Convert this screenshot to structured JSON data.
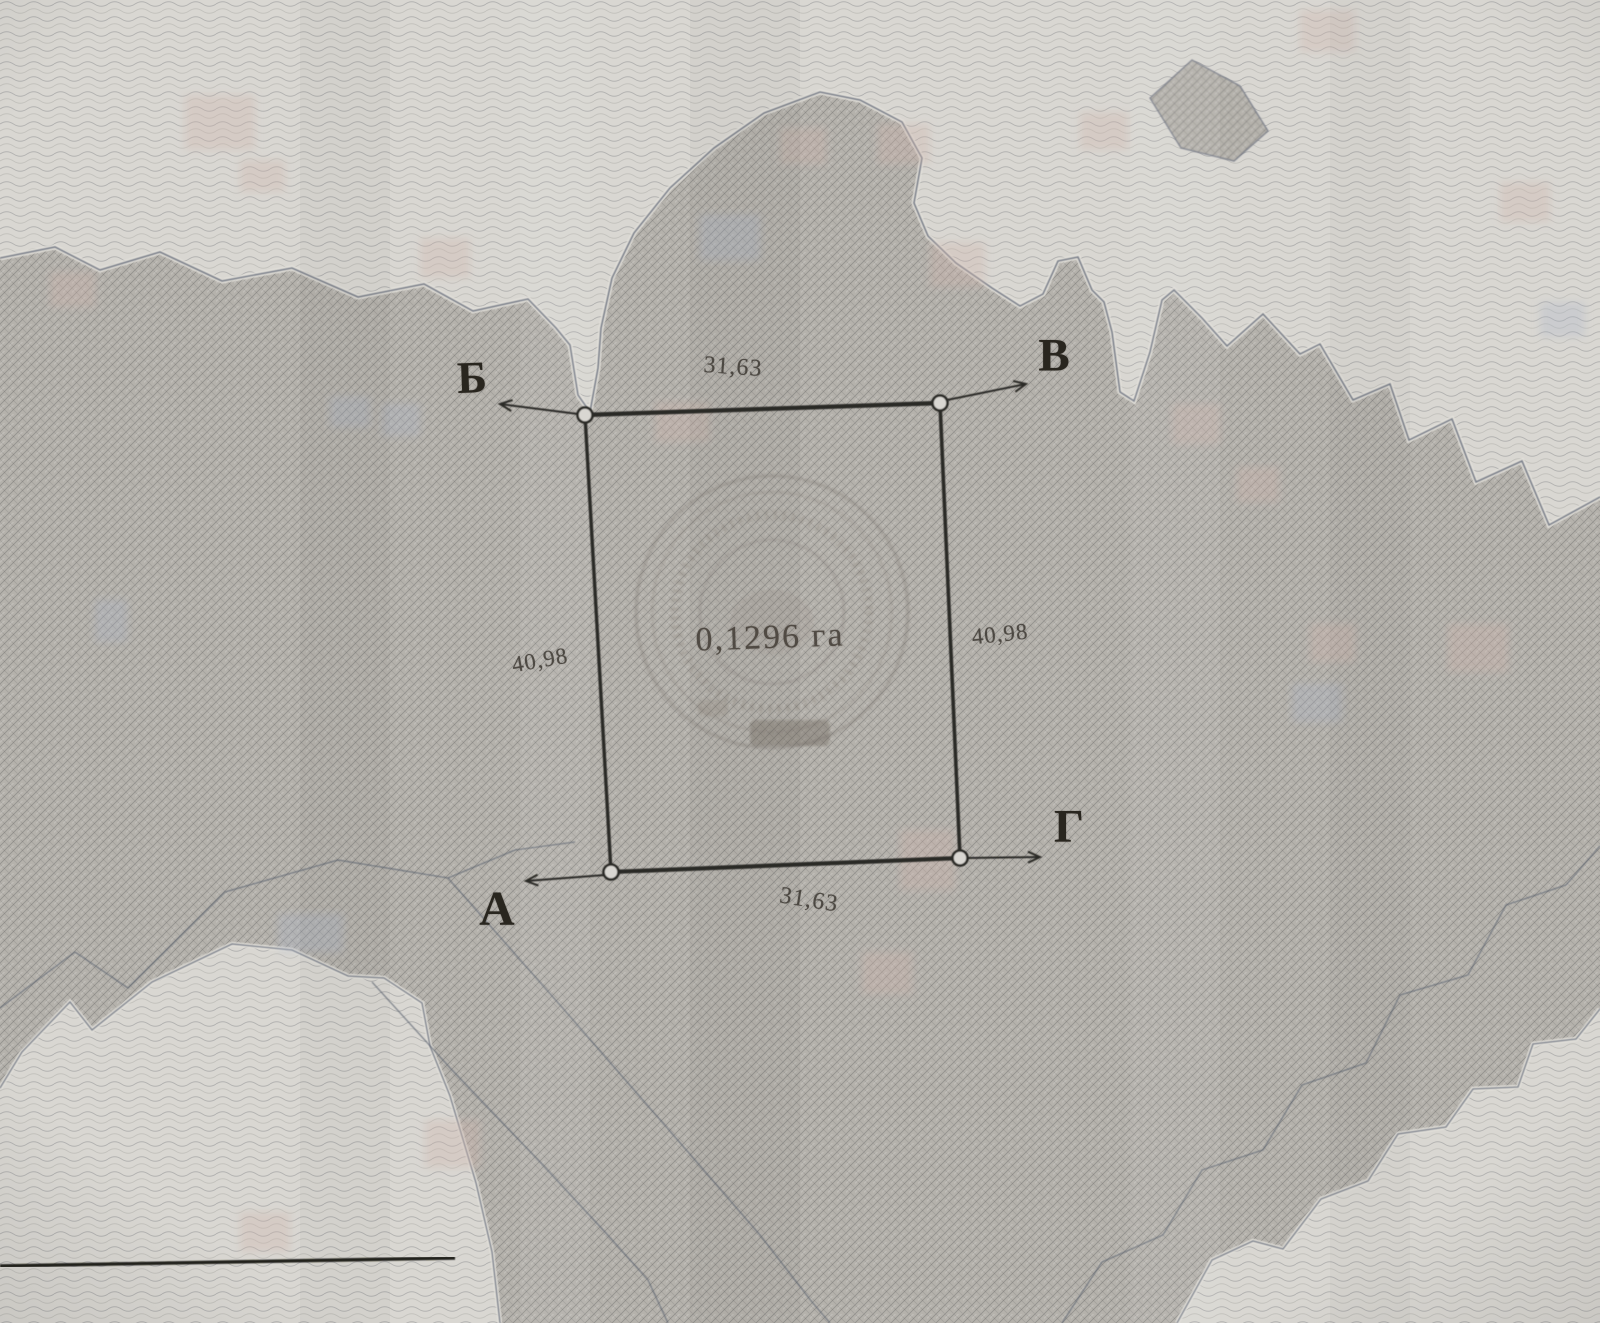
{
  "plot": {
    "corner_labels": {
      "top_left": "Б",
      "top_right": "В",
      "bottom_left": "А",
      "bottom_right": "Г"
    },
    "side_lengths": {
      "top": "31,63",
      "bottom": "31,63",
      "left": "40,98",
      "right": "40,98"
    },
    "area_label": "0,1296 га"
  },
  "colors": {
    "paper_light": "#d9d7d2",
    "paper_dark": "#b5b2ac",
    "ink": "#2c2a26",
    "zone_boundary": "#6c7280",
    "tint_pink": "#cfb2aa",
    "tint_blue": "#a8b2c6"
  }
}
